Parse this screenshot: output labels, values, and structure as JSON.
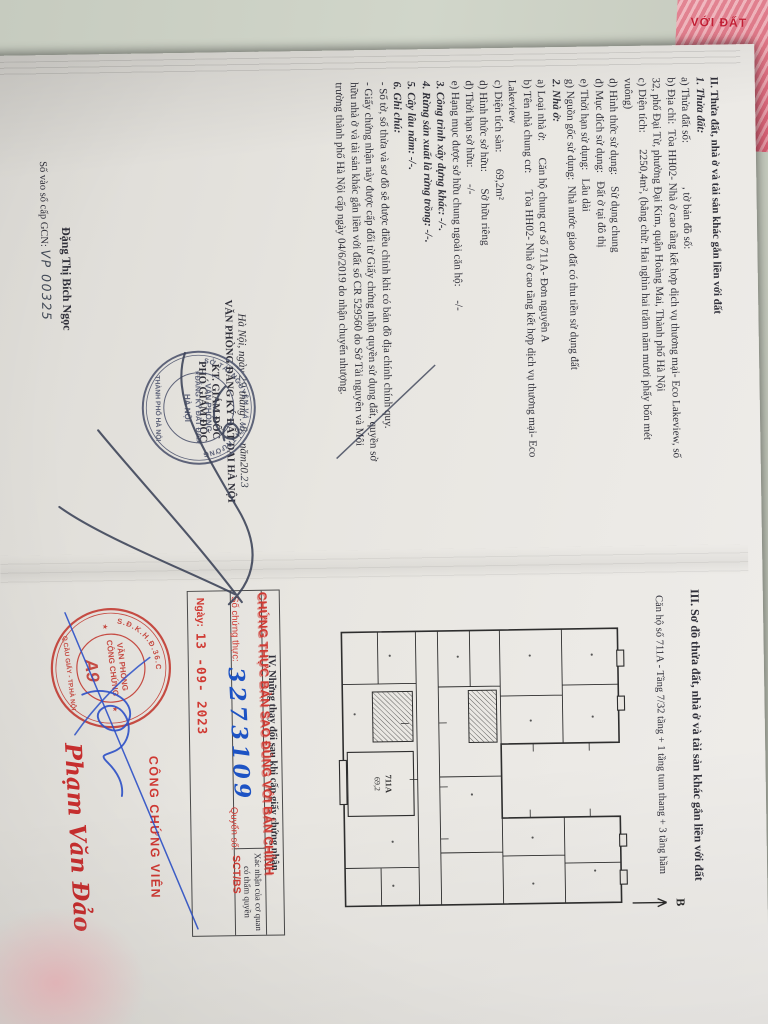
{
  "colors": {
    "red_stamp": "#cf3832",
    "blue_ink": "#2b50c8",
    "navy_ink": "#3b4257",
    "paper": "#e8e6e1",
    "cover_pink": "#e58f9b"
  },
  "cover": {
    "title_fragment": "VỚI ĐẤT"
  },
  "page2": {
    "section2": {
      "lines": [
        {
          "style": "b",
          "text": "II. Thửa đất, nhà ở và tài sản khác gắn liền với đất"
        },
        {
          "style": "bi",
          "text": "1. Thửa đất:"
        },
        {
          "style": "n",
          "text": "a) Thửa đất số:                , tờ bản đồ số:"
        },
        {
          "style": "n",
          "text": "b) Địa chỉ:  Tòa HH02- Nhà ở cao tầng kết hợp dịch vụ thương mại- Eco Lakeview, số"
        },
        {
          "style": "n",
          "text": "32, phố Đại Từ, phường Đại Kim, quận Hoàng Mai, Thành phố Hà Nội"
        },
        {
          "style": "n",
          "text": "c) Diện tích:      2250,4m², (bằng chữ: Hai nghìn hai trăm năm mươi phẩy bốn mét"
        },
        {
          "style": "n",
          "text": "vuông)"
        },
        {
          "style": "n",
          "text": "d) Hình thức sử dụng:    Sử dụng chung"
        },
        {
          "style": "n",
          "text": "đ) Mục đích sử dụng:   Đất ở tại đô thị"
        },
        {
          "style": "n",
          "text": "e) Thời hạn sử dụng:   Lâu dài"
        },
        {
          "style": "n",
          "text": "g) Nguồn gốc sử dụng:  Nhà nước giao đất có thu tiền sử dụng đất"
        },
        {
          "style": "bi",
          "text": "2. Nhà ở:"
        },
        {
          "style": "n",
          "text": "a) Loại nhà ở:      Căn hộ chung cư số 711A- Đơn nguyên A"
        },
        {
          "style": "n",
          "text": "b) Tên nhà chung cư:      Tòa HH02- Nhà ở cao tầng kết hợp dịch vụ thương mại- Eco"
        },
        {
          "style": "n",
          "text": "Lakeview"
        },
        {
          "style": "n",
          "text": "c) Diện tích sàn:      69,2m²"
        },
        {
          "style": "n",
          "text": "d) Hình thức sở hữu:      Sở hữu riêng"
        },
        {
          "style": "n",
          "text": "đ) Thời hạn sở hữu:      -/-"
        },
        {
          "style": "n",
          "text": "e) Hạng mục được sở hữu chung ngoài căn hộ:     -/-"
        },
        {
          "style": "bi",
          "text": "3. Công trình xây dựng khác: -/-."
        },
        {
          "style": "bi",
          "text": "4. Rừng sản xuất là rừng trồng: -/-."
        },
        {
          "style": "bi",
          "text": "5. Cây lâu năm: -/-."
        },
        {
          "style": "bi",
          "text": "6. Ghi chú:"
        },
        {
          "style": "n",
          "text": "- Số tờ, số thửa và sơ đồ sẽ được điều chỉnh khi có bản đồ địa chính chính quy."
        },
        {
          "style": "n",
          "text": "- Giấy chứng nhận này được cấp đổi từ Giấy chứng nhận quyền sử dụng đất, quyền sở"
        },
        {
          "style": "n",
          "text": "hữu nhà ở và tài sản khác gắn liền với đất số CR 529560 do Sở Tài nguyên và Môi"
        },
        {
          "style": "n",
          "text": "trường thành phố Hà Nội cấp ngày 04/6/2019 do nhận chuyển nhượng."
        }
      ]
    },
    "sign_block": {
      "date_prefix": "Hà Nội, ngày",
      "date_day": "29",
      "date_thang": "tháng",
      "date_month": "..8..",
      "date_nam": "năm",
      "date_year_printed": "20.",
      "date_year_hand": "23",
      "org": "VĂN PHÒNG ĐĂNG KÝ ĐẤT ĐAI HÀ NỘI",
      "kt": "KT. GIÁM ĐỐC",
      "role": "PHÓ GIÁM ĐỐC",
      "signer": "Đặng Thị Bích Ngọc"
    },
    "registry_stamp": {
      "ring_top": "SỞ TÀI NGUYÊN VÀ MÔI TRƯỜNG",
      "ring_bottom": "THÀNH PHỐ HÀ NỘI",
      "center1": "VĂN PHÒNG",
      "center2": "ĐĂNG KÝ ĐẤT ĐAI",
      "center3": "HÀ NỘI"
    },
    "gcn": {
      "label": "Số vào sổ cấp GCN:",
      "value": "VP 00325"
    }
  },
  "page3": {
    "section3_title": "III. Sơ đồ thửa đất, nhà ở và tài sản khác gắn liền với đất",
    "apartment_line": "Căn hộ số 711A - Tầng 7/32 tầng + 1 tầng tum thang + 3 tầng hầm",
    "north_label": "B",
    "plan": {
      "unit_label": "711A",
      "unit_area": "69,2"
    },
    "section4": {
      "title": "IV. Những thay đổi sau khi cấp giấy chứng nhận",
      "col_right_line1": "Xác nhận của cơ quan",
      "col_right_line2": "có thẩm quyền"
    },
    "certify_stamp": {
      "title": "CHỨNG THỰC BẢN SAO ĐÚNG VỚI BẢN CHÍNH",
      "no_label": "Số chứng thực:",
      "no_value": "3273109",
      "book_label": "Quyển số:",
      "book_value": "SCT/BS",
      "date_label": "Ngày:",
      "date_value": "13 -09- 2023"
    },
    "notary": {
      "role": "CÔNG CHỨNG VIÊN",
      "name": "Phạm Văn Đảo",
      "ring_top": "S.Đ.K.H.Đ.36.C",
      "ring_bottom": "Q.CẦU GIẤY - TP.HÀ NỘI",
      "center1": "VĂN PHÒNG",
      "center2": "CÔNG CHỨNG",
      "badge": "A9"
    }
  }
}
